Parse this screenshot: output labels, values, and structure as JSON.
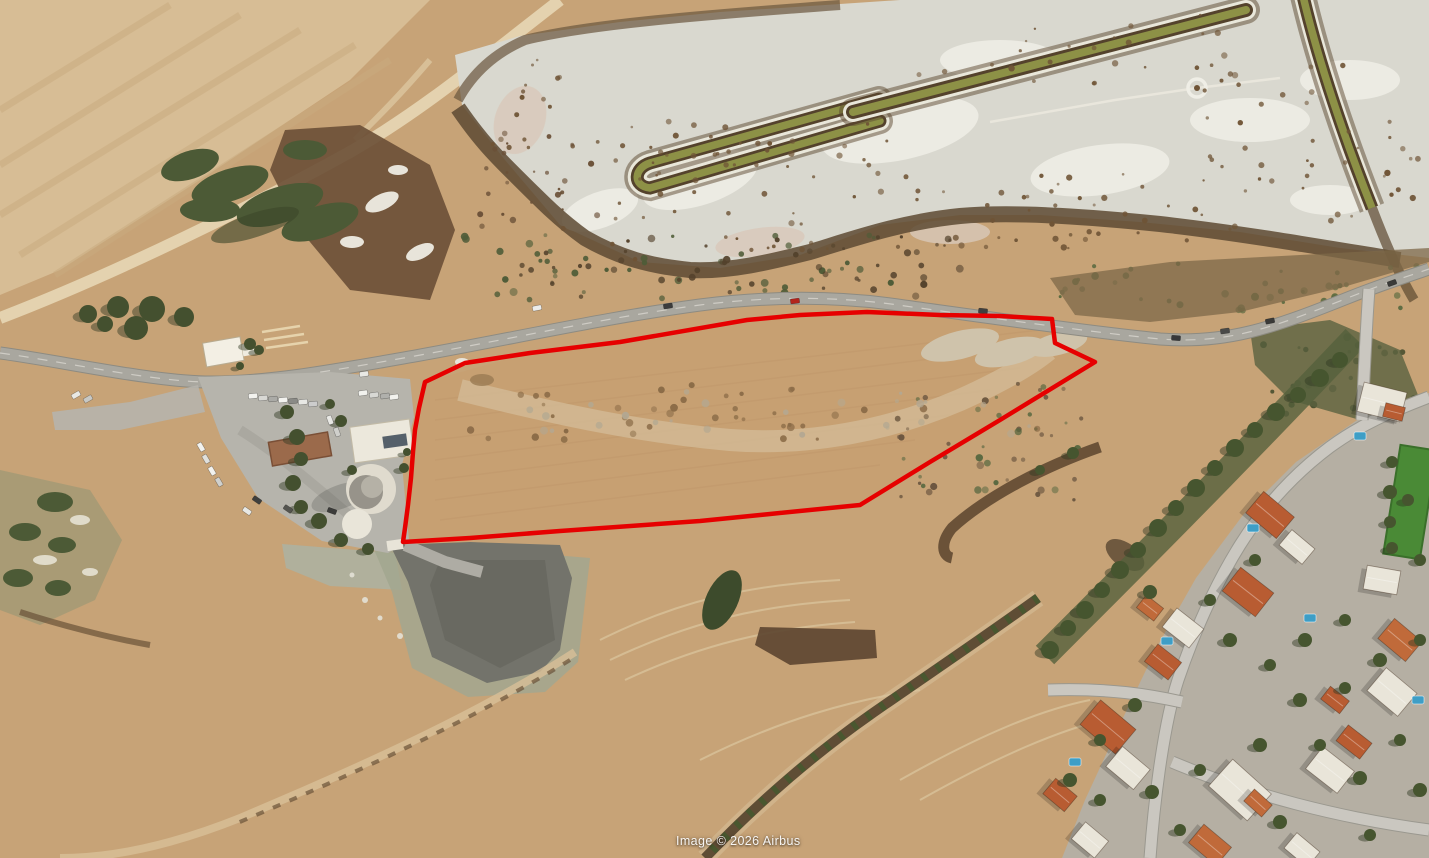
{
  "watermark": {
    "text": "Image © 2026 Airbus"
  },
  "palette": {
    "parcel_red": "#e60000",
    "field_tan": "#c7a377",
    "field_light": "#d7bd95",
    "salt_flat": "#d9d8cf",
    "scrub_brown": "#5d4a33",
    "shrub_green": "#49572f",
    "channel_olive": "#8d9146",
    "road_gray": "#a9a79f",
    "parking_gray": "#b6b4ac",
    "quarry_gray": "#73736b",
    "neighborhood_ground": "#b5afa3",
    "house_white": "#e9e5d9",
    "house_orange": "#b85c32",
    "pool_blue": "#3e9ec6",
    "lawn_green": "#4a8a36",
    "speckle_brown": "#6f5436"
  },
  "map": {
    "parcel_outline": {
      "color": "#e60000",
      "stroke_width": 4.5,
      "points": "425,382 465,363 530,353 620,342 747,320 800,315 867,312 940,315 1000,316 1052,319 1055,343 1095,362 1000,420 930,462 860,505 770,514 700,521 560,531 470,538 403,542 405,528 408,505 411,478 413,452 415,430 419,408"
    },
    "main_road_path": "M0,353 C60,361 150,381 205,382 C265,383 330,371 415,356 C520,337 610,317 700,305 C770,296 840,296 905,306 C985,317 1090,332 1160,339 C1225,344 1270,329 1345,299 C1385,283 1412,275 1429,269",
    "neighborhood_roads": [
      "M1429,397 C1390,412 1360,425 1330,447 C1290,477 1262,510 1240,545 C1215,585 1195,630 1178,680 C1165,720 1155,790 1150,858",
      "M1182,702 C1150,695 1110,688 1048,690",
      "M1172,762 C1250,795 1340,818 1429,830",
      "M1369,289 C1366,330 1364,375 1362,420"
    ],
    "houses": [
      [
        1248,
        592,
        42,
        30,
        38,
        "#b85c32"
      ],
      [
        1183,
        628,
        34,
        24,
        38,
        "#e9e5d9"
      ],
      [
        1163,
        662,
        30,
        22,
        38,
        "#b85c32"
      ],
      [
        1108,
        727,
        46,
        32,
        40,
        "#b85c32"
      ],
      [
        1128,
        768,
        36,
        26,
        40,
        "#e9e5d9"
      ],
      [
        1240,
        790,
        52,
        36,
        42,
        "#e9e5d9"
      ],
      [
        1258,
        803,
        24,
        16,
        42,
        "#c06a3a"
      ],
      [
        1330,
        770,
        40,
        28,
        38,
        "#e9e5d9"
      ],
      [
        1354,
        742,
        30,
        20,
        38,
        "#b85c32"
      ],
      [
        1392,
        692,
        40,
        30,
        40,
        "#e9e5d9"
      ],
      [
        1400,
        640,
        36,
        26,
        40,
        "#c06a3a"
      ],
      [
        1382,
        580,
        34,
        24,
        10,
        "#e9e5d9"
      ],
      [
        1270,
        515,
        40,
        28,
        40,
        "#b85c32"
      ],
      [
        1297,
        547,
        30,
        20,
        40,
        "#e9e5d9"
      ],
      [
        1382,
        402,
        44,
        30,
        14,
        "#e9e5d9"
      ],
      [
        1394,
        412,
        20,
        14,
        14,
        "#b85c32"
      ],
      [
        1210,
        845,
        36,
        24,
        40,
        "#c06a3a"
      ],
      [
        1302,
        850,
        30,
        20,
        40,
        "#e9e5d9"
      ],
      [
        1090,
        840,
        30,
        22,
        40,
        "#e9e5d9"
      ],
      [
        1060,
        795,
        28,
        20,
        40,
        "#b85c32"
      ],
      [
        1150,
        608,
        22,
        16,
        38,
        "#c06a3a"
      ],
      [
        1335,
        700,
        24,
        16,
        38,
        "#b85c32"
      ]
    ],
    "pools": [
      [
        1167,
        641
      ],
      [
        1075,
        762
      ],
      [
        1253,
        528
      ],
      [
        1360,
        436
      ],
      [
        1418,
        700
      ],
      [
        1310,
        618
      ]
    ],
    "trees_neighborhood": [
      [
        1050,
        650,
        9
      ],
      [
        1068,
        628,
        8
      ],
      [
        1085,
        610,
        9
      ],
      [
        1102,
        590,
        8
      ],
      [
        1120,
        570,
        9
      ],
      [
        1138,
        550,
        8
      ],
      [
        1158,
        528,
        9
      ],
      [
        1176,
        508,
        8
      ],
      [
        1196,
        488,
        9
      ],
      [
        1215,
        468,
        8
      ],
      [
        1235,
        448,
        9
      ],
      [
        1255,
        430,
        8
      ],
      [
        1276,
        412,
        9
      ],
      [
        1298,
        395,
        8
      ],
      [
        1320,
        378,
        9
      ],
      [
        1340,
        360,
        8
      ],
      [
        1150,
        592,
        7
      ],
      [
        1210,
        600,
        6
      ],
      [
        1230,
        640,
        7
      ],
      [
        1270,
        665,
        6
      ],
      [
        1305,
        640,
        7
      ],
      [
        1345,
        620,
        6
      ],
      [
        1300,
        700,
        7
      ],
      [
        1345,
        688,
        6
      ],
      [
        1380,
        660,
        7
      ],
      [
        1420,
        640,
        6
      ],
      [
        1135,
        705,
        7
      ],
      [
        1100,
        740,
        6
      ],
      [
        1070,
        780,
        7
      ],
      [
        1100,
        800,
        6
      ],
      [
        1152,
        792,
        7
      ],
      [
        1200,
        770,
        6
      ],
      [
        1260,
        745,
        7
      ],
      [
        1320,
        745,
        6
      ],
      [
        1360,
        778,
        7
      ],
      [
        1400,
        740,
        6
      ],
      [
        1420,
        790,
        7
      ],
      [
        1180,
        830,
        6
      ],
      [
        1280,
        822,
        7
      ],
      [
        1370,
        835,
        6
      ],
      [
        1420,
        560,
        6
      ],
      [
        1408,
        500,
        6
      ],
      [
        1392,
        462,
        6
      ],
      [
        1390,
        492,
        7
      ],
      [
        1390,
        522,
        6
      ],
      [
        1392,
        548,
        6
      ],
      [
        1255,
        560,
        6
      ],
      [
        1073,
        453,
        6
      ],
      [
        1040,
        470,
        5
      ]
    ],
    "trees_church": [
      [
        287,
        412,
        7
      ],
      [
        297,
        437,
        8
      ],
      [
        301,
        459,
        7
      ],
      [
        293,
        483,
        8
      ],
      [
        301,
        507,
        7
      ],
      [
        319,
        521,
        8
      ],
      [
        341,
        540,
        7
      ],
      [
        368,
        549,
        6
      ],
      [
        404,
        468,
        5
      ],
      [
        407,
        452,
        4
      ],
      [
        341,
        421,
        6
      ],
      [
        330,
        404,
        5
      ],
      [
        250,
        344,
        6
      ],
      [
        259,
        350,
        5
      ],
      [
        240,
        366,
        4
      ],
      [
        352,
        470,
        5
      ]
    ],
    "trees_roadside": [
      [
        88,
        314,
        9
      ],
      [
        118,
        307,
        11
      ],
      [
        152,
        309,
        13
      ],
      [
        184,
        317,
        10
      ],
      [
        136,
        328,
        12
      ],
      [
        105,
        324,
        8
      ]
    ],
    "cars_parking": [
      [
        253,
        396,
        -6,
        "#f2f2ee"
      ],
      [
        263,
        398,
        -6,
        "#d8d8d4"
      ],
      [
        273,
        399,
        -6,
        "#aaaaa6"
      ],
      [
        283,
        400,
        -6,
        "#f2f2ee"
      ],
      [
        293,
        401,
        -6,
        "#8a8a86"
      ],
      [
        303,
        402,
        -6,
        "#e8e8e4"
      ],
      [
        313,
        404,
        -6,
        "#cccccc"
      ],
      [
        363,
        393,
        -8,
        "#f2f2ee"
      ],
      [
        374,
        395,
        -8,
        "#d8d8d4"
      ],
      [
        385,
        396,
        -8,
        "#b0b0ac"
      ],
      [
        394,
        397,
        -8,
        "#f2f2ee"
      ],
      [
        364,
        374,
        -8,
        "#e8e8e4"
      ],
      [
        201,
        447,
        60,
        "#f2f2ee"
      ],
      [
        206,
        459,
        60,
        "#e0e0dc"
      ],
      [
        212,
        471,
        60,
        "#f2f2ee"
      ],
      [
        219,
        482,
        60,
        "#d0d0cc"
      ],
      [
        257,
        500,
        35,
        "#3f3f3d"
      ],
      [
        288,
        509,
        35,
        "#54544f"
      ],
      [
        247,
        511,
        35,
        "#e8e8e4"
      ],
      [
        330,
        420,
        70,
        "#e8e8e4"
      ],
      [
        337,
        432,
        70,
        "#cfcfcb"
      ],
      [
        332,
        511,
        20,
        "#3c3c3a"
      ],
      [
        76,
        395,
        -30,
        "#e8e8e4"
      ],
      [
        88,
        399,
        -30,
        "#c8c8c4"
      ]
    ],
    "cars_road": [
      [
        795,
        301,
        -7,
        "#b3241c"
      ],
      [
        668,
        306,
        -9,
        "#3c3c3c"
      ],
      [
        537,
        308,
        -11,
        "#ececea"
      ],
      [
        983,
        311,
        6,
        "#3f3f3f"
      ],
      [
        1176,
        338,
        4,
        "#38383a"
      ],
      [
        1225,
        331,
        -8,
        "#4a4a48"
      ],
      [
        1270,
        321,
        -12,
        "#3a3a38"
      ],
      [
        1392,
        283,
        -20,
        "#3a3a38"
      ]
    ],
    "speckle_clusters": [
      {
        "x0": 560,
        "y0": 140,
        "x1": 900,
        "y1": 260,
        "n": 45,
        "c": "#6f5436"
      },
      {
        "x0": 900,
        "y0": 170,
        "x1": 1200,
        "y1": 250,
        "n": 40,
        "c": "#6f5436"
      },
      {
        "x0": 1200,
        "y0": 60,
        "x1": 1420,
        "y1": 230,
        "n": 45,
        "c": "#6f5436"
      },
      {
        "x0": 460,
        "y0": 60,
        "x1": 560,
        "y1": 160,
        "n": 15,
        "c": "#6f5436"
      },
      {
        "x0": 900,
        "y0": 15,
        "x1": 1230,
        "y1": 95,
        "n": 25,
        "c": "#6f5436"
      },
      {
        "x0": 620,
        "y0": 120,
        "x1": 900,
        "y1": 165,
        "n": 20,
        "c": "#6f5436"
      },
      {
        "x0": 480,
        "y0": 130,
        "x1": 600,
        "y1": 230,
        "n": 25,
        "c": "#6b5138"
      }
    ],
    "scrub_dot_clusters": [
      {
        "x0": 460,
        "y0": 235,
        "x1": 960,
        "y1": 300,
        "n": 50,
        "c": "#4f5c38"
      },
      {
        "x0": 470,
        "y0": 235,
        "x1": 960,
        "y1": 298,
        "n": 50,
        "c": "#54422c"
      },
      {
        "x0": 1060,
        "y0": 258,
        "x1": 1420,
        "y1": 312,
        "n": 40,
        "c": "#5a6a40"
      },
      {
        "x0": 880,
        "y0": 380,
        "x1": 1085,
        "y1": 500,
        "n": 30,
        "c": "#6b5640"
      },
      {
        "x0": 890,
        "y0": 385,
        "x1": 1080,
        "y1": 495,
        "n": 20,
        "c": "#55663f"
      },
      {
        "x0": 470,
        "y0": 385,
        "x1": 1040,
        "y1": 440,
        "n": 40,
        "c": "#8a6b47"
      },
      {
        "x0": 480,
        "y0": 388,
        "x1": 1030,
        "y1": 438,
        "n": 25,
        "c": "#b3a892"
      },
      {
        "x0": 1260,
        "y0": 335,
        "x1": 1420,
        "y1": 415,
        "n": 30,
        "c": "#3a4527"
      }
    ]
  }
}
